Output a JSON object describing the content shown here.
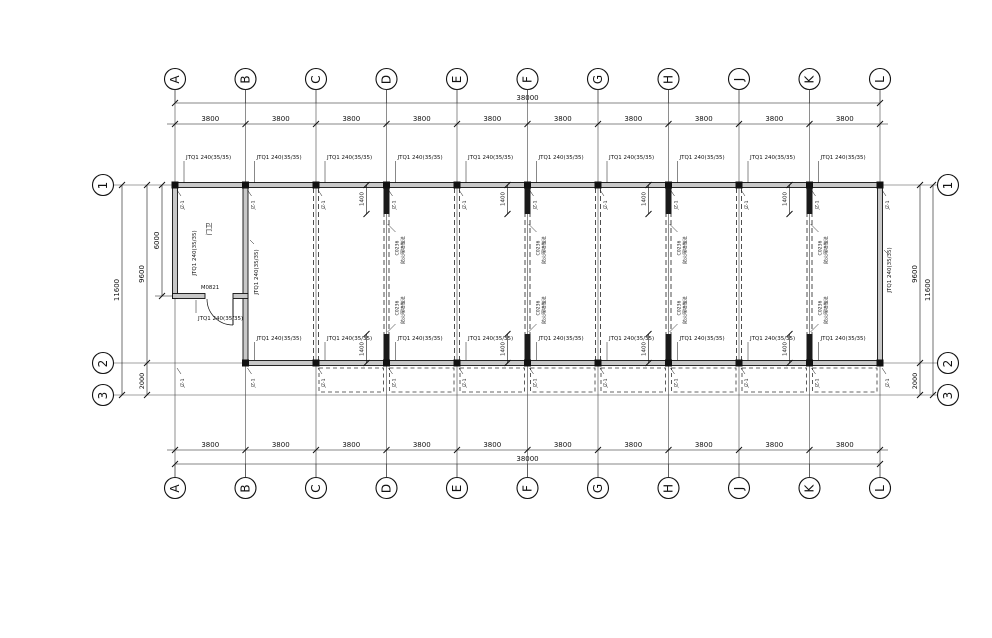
{
  "drawing": {
    "axis_bubbles": {
      "columns": [
        "A",
        "B",
        "C",
        "D",
        "E",
        "F",
        "G",
        "H",
        "J",
        "K",
        "L"
      ],
      "rows": [
        "1",
        "2",
        "3"
      ]
    },
    "dimensions": {
      "bay_width": "3800",
      "total_width": "38000",
      "left": {
        "overall": "11600",
        "row1_to_row2": "9600",
        "row2_to_row3": "2000",
        "room_depth": "6000"
      },
      "right": {
        "overall": "11600",
        "row1_to_row2": "9600",
        "row2_to_row3": "2000"
      },
      "stub_length": "1400"
    },
    "labels": {
      "wall_type": "JTQ1 240(35/35)",
      "column_tag": "JZ-1",
      "door_tag": "M0821",
      "room_name": "门卫",
      "partition_note_line1": "C0236",
      "partition_note_line2": "防火隔墙做法"
    }
  }
}
